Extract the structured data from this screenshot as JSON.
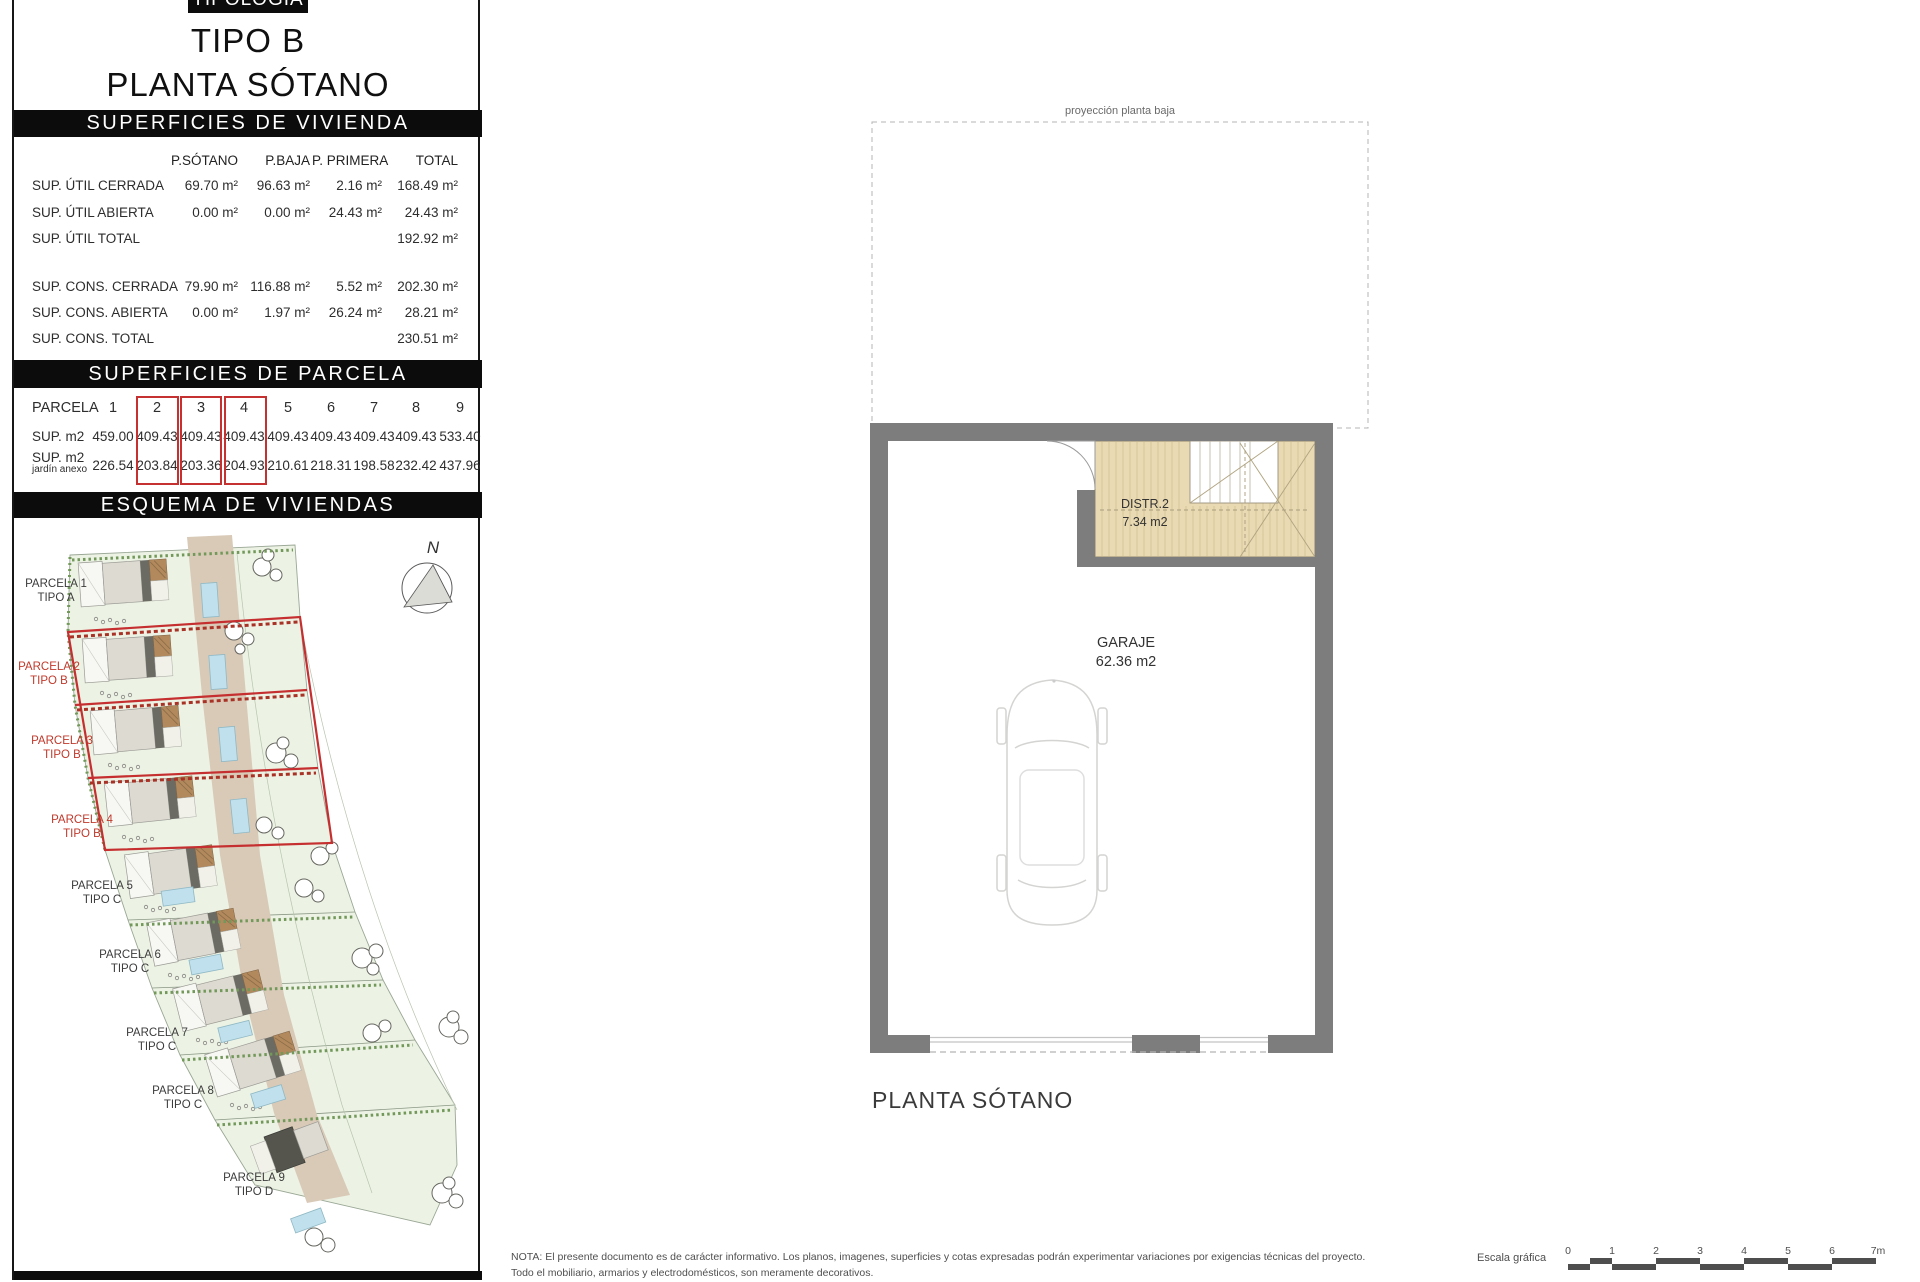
{
  "panel": {
    "top_bar": "TIPOLOGÍA",
    "title_line1": "TIPO B",
    "title_line2": "PLANTA SÓTANO",
    "section_vivienda": "SUPERFICIES DE VIVIENDA",
    "section_parcela": "SUPERFICIES DE PARCELA",
    "section_esquema": "ESQUEMA DE VIVIENDAS",
    "vivienda": {
      "columns": [
        "P.SÓTANO",
        "P.BAJA",
        "P. PRIMERA",
        "TOTAL"
      ],
      "rows": [
        {
          "label": "SUP. ÚTIL CERRADA",
          "values": [
            "69.70 m²",
            "96.63 m²",
            "2.16 m²",
            "168.49 m²"
          ]
        },
        {
          "label": "SUP. ÚTIL ABIERTA",
          "values": [
            "0.00 m²",
            "0.00 m²",
            "24.43 m²",
            "24.43 m²"
          ]
        },
        {
          "label": "SUP. ÚTIL TOTAL",
          "values": [
            "",
            "",
            "",
            "192.92 m²"
          ]
        },
        {
          "label": "SUP. CONS.  CERRADA",
          "values": [
            "79.90 m²",
            "116.88 m²",
            "5.52 m²",
            "202.30 m²"
          ]
        },
        {
          "label": "SUP. CONS.  ABIERTA",
          "values": [
            "0.00 m²",
            "1.97 m²",
            "26.24 m²",
            "28.21 m²"
          ]
        },
        {
          "label": "SUP. CONS.  TOTAL",
          "values": [
            "",
            "",
            "",
            "230.51 m²"
          ]
        }
      ]
    },
    "parcela": {
      "row_label": "PARCELA",
      "sup_label": "SUP. m2",
      "jardin_label_1": "SUP. m2",
      "jardin_label_2": "jardín anexo",
      "numbers": [
        "1",
        "2",
        "3",
        "4",
        "5",
        "6",
        "7",
        "8",
        "9"
      ],
      "sup": [
        "459.00",
        "409.43",
        "409.43",
        "409.43",
        "409.43",
        "409.43",
        "409.43",
        "409.43",
        "533.40"
      ],
      "jardin": [
        "226.54",
        "203.84",
        "203.36",
        "204.93",
        "210.61",
        "218.31",
        "198.58",
        "232.42",
        "437.96"
      ],
      "highlighted_parcels": [
        "2",
        "3",
        "4"
      ]
    },
    "esquema": {
      "north": "N",
      "parcels": [
        {
          "name": "PARCELA 1",
          "tipo": "TIPO A",
          "red": false
        },
        {
          "name": "PARCELA 2",
          "tipo": "TIPO B",
          "red": true
        },
        {
          "name": "PARCELA 3",
          "tipo": "TIPO B",
          "red": true
        },
        {
          "name": "PARCELA 4",
          "tipo": "TIPO B",
          "red": true
        },
        {
          "name": "PARCELA 5",
          "tipo": "TIPO C",
          "red": false
        },
        {
          "name": "PARCELA 6",
          "tipo": "TIPO C",
          "red": false
        },
        {
          "name": "PARCELA 7",
          "tipo": "TIPO C",
          "red": false
        },
        {
          "name": "PARCELA 8",
          "tipo": "TIPO C",
          "red": false
        },
        {
          "name": "PARCELA 9",
          "tipo": "TIPO D",
          "red": false
        }
      ]
    }
  },
  "floorplan": {
    "projection_label": "proyección planta baja",
    "distr_name": "DISTR.2",
    "distr_area": "7.34 m2",
    "garage_name": "GARAJE",
    "garage_area": "62.36 m2",
    "title": "PLANTA SÓTANO"
  },
  "footer": {
    "nota_line1": "NOTA: El presente documento es de carácter informativo. Los planos, imagenes, superficies y cotas expresadas podrán experimentar variaciones por exigencias técnicas del proyecto.",
    "nota_line2": "Todo el mobiliario, armarios y electrodomésticos, son meramente decorativos.",
    "escala_label": "Escala gráfica",
    "scale_ticks": [
      "0",
      "1",
      "2",
      "3",
      "4",
      "5",
      "6",
      "7m"
    ]
  },
  "colors": {
    "accent_red": "#c53030",
    "wall_gray": "#7d7d7d",
    "stairs_tan": "#e9dab3",
    "pool_blue": "#bfe0ec",
    "garden_green": "#ecf2e4",
    "driveway_tan": "#d9cab8"
  }
}
